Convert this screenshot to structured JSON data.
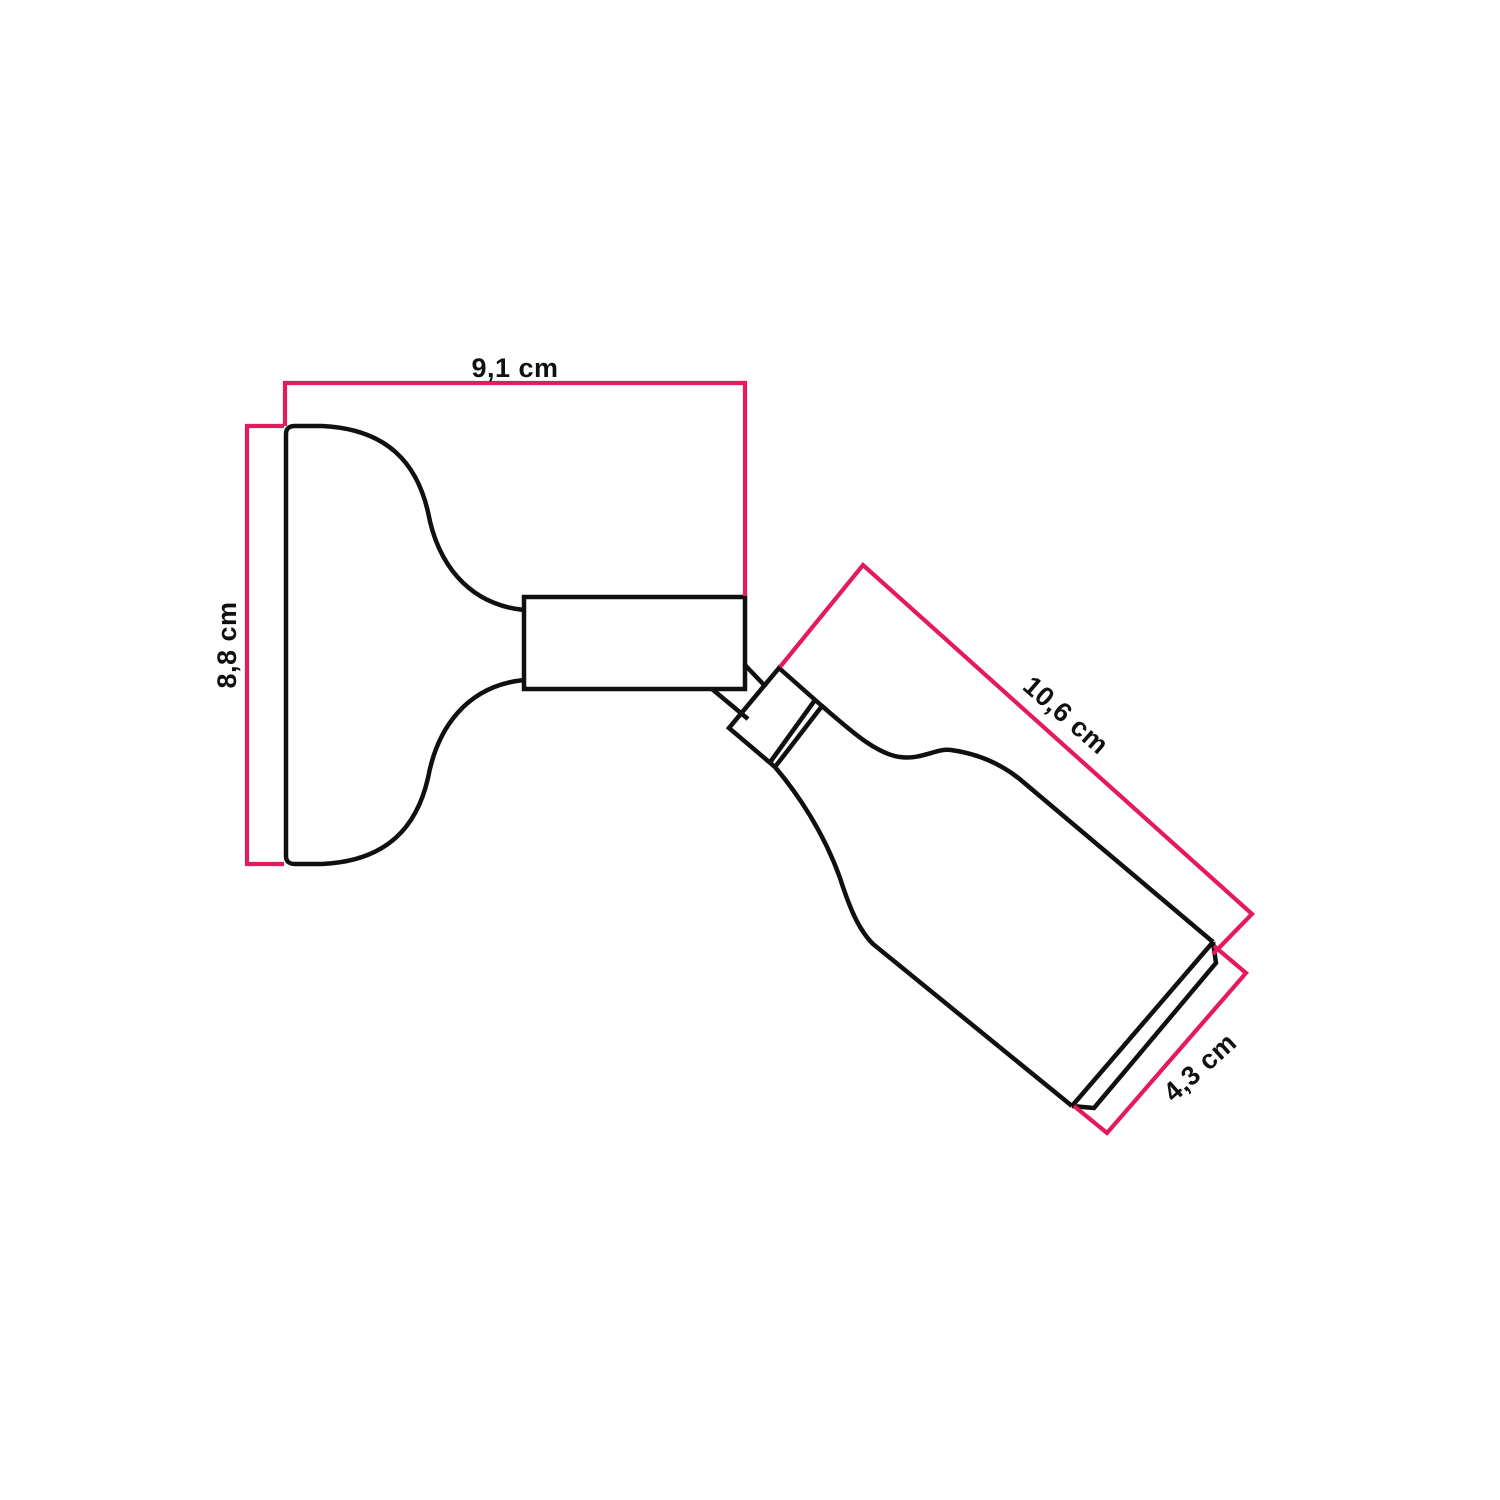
{
  "colors": {
    "accent": "#e5195e",
    "ink": "#101010",
    "background": "#ffffff"
  },
  "diagram": {
    "type": "product-dimension-drawing",
    "unit": "cm",
    "dimensions": [
      {
        "id": "base-width",
        "value": "9,1",
        "unit": "cm",
        "label": "9,1 cm"
      },
      {
        "id": "base-height",
        "value": "8,8",
        "unit": "cm",
        "label": "8,8 cm"
      },
      {
        "id": "spot-length",
        "value": "10,6",
        "unit": "cm",
        "label": "10,6 cm"
      },
      {
        "id": "spot-diameter",
        "value": "4,3",
        "unit": "cm",
        "label": "4,3 cm"
      }
    ]
  }
}
